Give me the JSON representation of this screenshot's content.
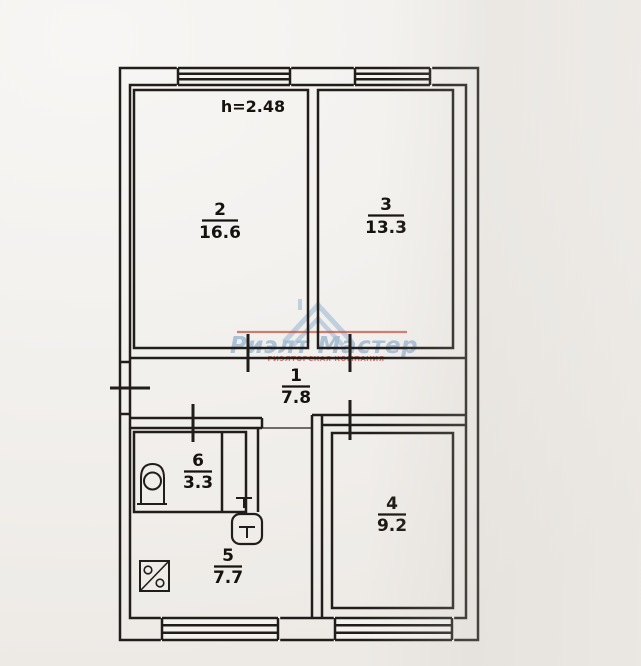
{
  "plan": {
    "ceiling_height": "h=2.48",
    "rooms": {
      "r1": {
        "number": "1",
        "area": "7.8"
      },
      "r2": {
        "number": "2",
        "area": "16.6"
      },
      "r3": {
        "number": "3",
        "area": "13.3"
      },
      "r4": {
        "number": "4",
        "area": "9.2"
      },
      "r5": {
        "number": "5",
        "area": "7.7"
      },
      "r6": {
        "number": "6",
        "area": "3.3"
      }
    },
    "fixtures": {
      "bath_icon": "bath-boiler",
      "toilet_icon": "toilet",
      "sink_icon": "kitchen-sink"
    }
  },
  "watermark": {
    "brand": "Риэлт Мастер",
    "tagline": "РИЭЛТОРСКАЯ КОМПАНИЯ"
  },
  "colors": {
    "ink": "#201d1a",
    "paper": "#f3f1ee",
    "watermark_blue": "#b4c7da",
    "watermark_red": "#c14b3c",
    "watermark_pink": "#d1766b"
  }
}
